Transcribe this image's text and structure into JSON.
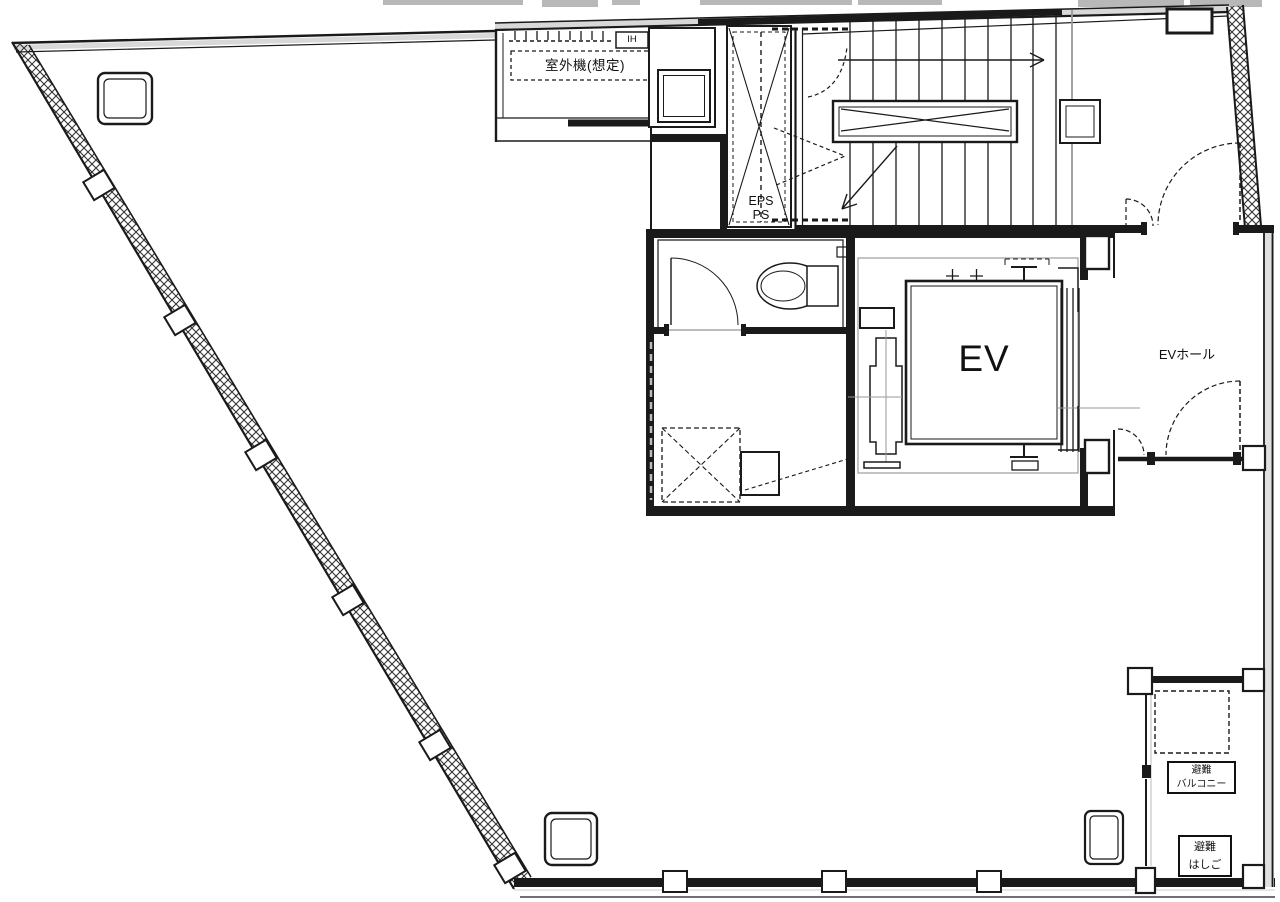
{
  "drawing": {
    "type": "architectural-floor-plan",
    "labels": {
      "outdoor_unit": "室外機(想定)",
      "ih": "IH",
      "eps": "EPS",
      "ps": "PS",
      "elevator": "EV",
      "ev_hall": "EVホール",
      "evac_balcony": [
        "避難",
        "バルコニー"
      ],
      "evac_ladder": [
        "避難",
        "はしご"
      ]
    },
    "line_color": "#1a1a1a",
    "gray_color": "#aaaaaa"
  }
}
